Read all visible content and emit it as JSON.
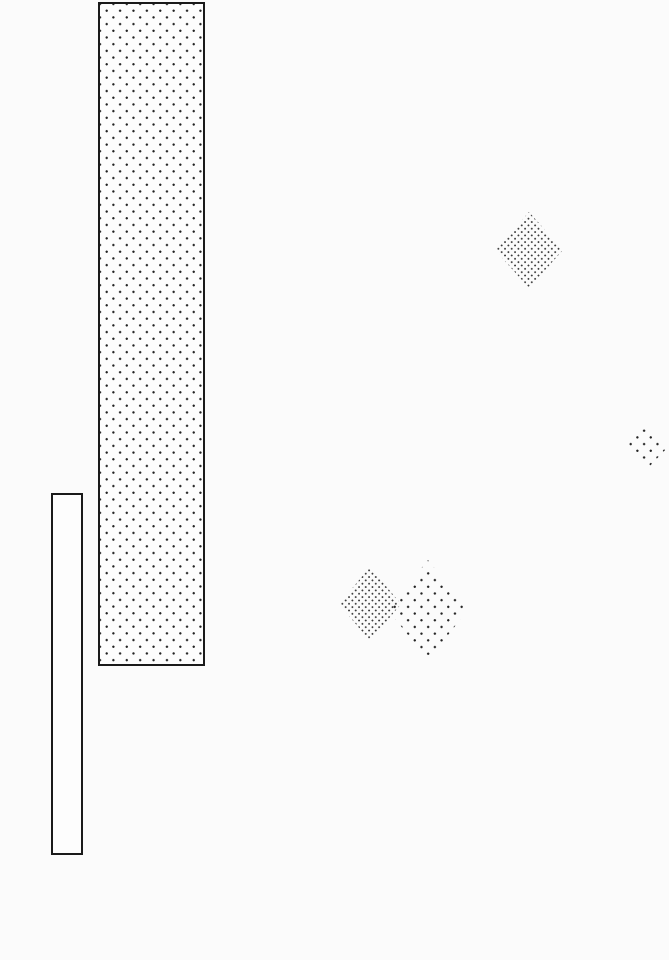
{
  "canvas": {
    "width": 669,
    "height": 960,
    "background": "#fbfbfb"
  },
  "palette": {
    "border_ink": "#1a1a1a",
    "dot_ink_sparse": "#222222",
    "dot_ink_dense": "#3a3a3a"
  },
  "patterns": {
    "dots-sparse": {
      "spacing": 13.4,
      "dot_radius": 1.0,
      "color": "#222222"
    },
    "dots-dense": {
      "spacing": 6.7,
      "dot_radius": 0.75,
      "color": "#3a3a3a"
    },
    "none": {
      "spacing": 0,
      "dot_radius": 0,
      "color": "transparent"
    }
  },
  "shapes": [
    {
      "id": "dotted-column",
      "type": "rect",
      "x": 98,
      "y": 2,
      "width": 107,
      "height": 664,
      "border_width": 2,
      "fill": "dots-sparse"
    },
    {
      "id": "outlined-bar",
      "type": "rect",
      "x": 51,
      "y": 493,
      "width": 32,
      "height": 362,
      "border_width": 2,
      "fill": "none"
    },
    {
      "id": "diamond-top-right",
      "type": "diamond",
      "cx": 529,
      "cy": 250,
      "width": 68,
      "height": 76,
      "border_width": 0,
      "fill": "dots-dense"
    },
    {
      "id": "diamond-right-edge",
      "type": "diamond",
      "cx": 646,
      "cy": 447,
      "width": 44,
      "height": 46,
      "border_width": 0,
      "fill": "dots-sparse"
    },
    {
      "id": "diamond-pair-right",
      "type": "diamond",
      "cx": 428,
      "cy": 610,
      "width": 80,
      "height": 100,
      "border_width": 0,
      "fill": "dots-sparse"
    },
    {
      "id": "diamond-pair-left",
      "type": "diamond",
      "cx": 370,
      "cy": 604,
      "width": 62,
      "height": 74,
      "border_width": 0,
      "fill": "dots-dense"
    }
  ]
}
